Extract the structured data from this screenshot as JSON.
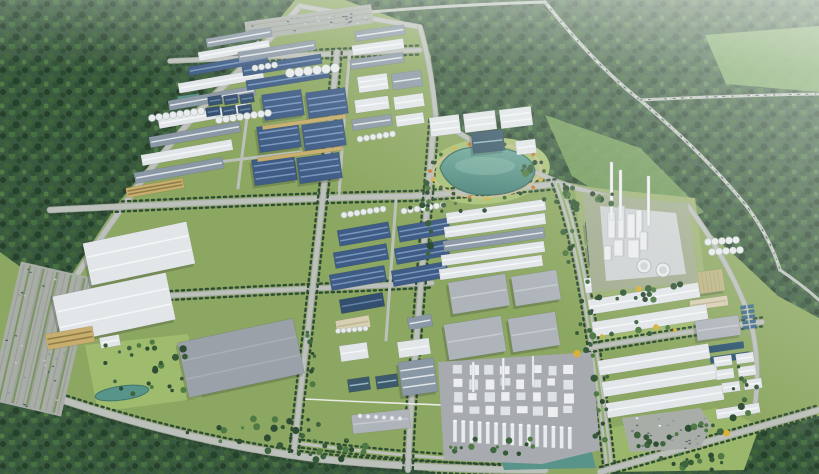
{
  "scene": {
    "width": 819,
    "height": 474,
    "description": "aerial-3d-render-industrial-park"
  },
  "palette": {
    "grassBase": "#8CA761",
    "grassLight": "#9FBB6E",
    "grassPark": "#A8C175",
    "forestMid": "#3A5A40",
    "clearing1": "#76A05C",
    "clearing2": "#7FAA64",
    "road": "#BCC0BA",
    "roadEdge": "#A4A8A2",
    "treeDark": "#2E4C33",
    "treeMid": "#3F653E",
    "treeAlt": "#365A38",
    "treeLight": "#4F7A43",
    "treeYellow": "#D9B13B",
    "shrubOrange": "#C97A35",
    "blue": "#3E5C85",
    "blueStripe": "#7E9CC2",
    "blued": "#344F6E",
    "bluedStripe": "#6888AC",
    "slate": "#8A97A5",
    "slateStripe": "#E8ECEF",
    "white": "#E2E6E9",
    "whiteStripe": "#F6F8F9",
    "gray": "#AEB4BA",
    "grayStripe": "#C8CDD1",
    "graybig": "#9BA1A8",
    "graybigStripe": "#AAB0B6",
    "beige": "#C7AE6E",
    "beigeStripe": "#8A7742",
    "beige2": "#D8CFB2",
    "beige2Stripe": "#BBB190",
    "tan": "#BDB583",
    "tanStripe": "#A8A171",
    "glass": "#3C5A6C",
    "glassStripe": "#9FC0C9",
    "lakeTop": "#6FA89A",
    "lakeBottom": "#4A8379",
    "lakeRim": "#3E6E66",
    "pond": "#58948A",
    "basin": "#2E5470",
    "basinLight": "#3A6A8C",
    "pad": "#A7ABAF",
    "padLight": "#CFD3D4",
    "siteGreen": "#A2AD90",
    "towerWhite": "#ECEEEF",
    "towerShade": "#BDC3C8",
    "parking": "#A9ADA8",
    "parkStripe": "#98A094",
    "pathBeige": "#C9BD96",
    "pipe": "#EDEDEA",
    "shadow": "rgba(35,45,40,0.22)",
    "carDark": "#4B545C",
    "carLight": "#E8ECEC"
  },
  "forests": [
    {
      "pts": "0,0 295,0 252,52 196,108 118,203 60,292 22,268 0,252"
    },
    {
      "pts": "345,0 819,0 819,318 778,296 742,262 704,228 690,207 642,199 602,189 560,181 436,119 431,56 419,27"
    },
    {
      "pts": "0,400 33,392 150,428 300,458 420,468 436,474 0,474"
    },
    {
      "pts": "608,474 819,416 819,474"
    }
  ],
  "clearings": [
    {
      "pts": "545,115 640,148 704,212 662,232 572,176",
      "c": "clearing1"
    },
    {
      "pts": "705,35 819,26 819,92 726,84",
      "c": "clearing2"
    }
  ],
  "lawns": [
    {
      "pts": "85,345 188,334 202,398 98,412",
      "c": "#9FBB6E"
    },
    {
      "pts": "588,332 712,318 716,332 592,348",
      "c": "#9FBB6E"
    },
    {
      "pts": "575,186 695,198 706,288 585,298",
      "c": "#9DB174"
    },
    {
      "pts": "600,430 716,408 760,425 744,470 612,472",
      "c": "#9BB76B"
    }
  ],
  "lakePark": {
    "cx": 487,
    "cy": 171,
    "rx": 63,
    "ry": 33,
    "rot": -5,
    "c": "#A8C175"
  },
  "roads": [
    {
      "d": "M300,6 C272,38 232,78 200,110 C152,163 100,235 63,298 C50,330 41,358 33,390",
      "w": 5
    },
    {
      "d": "M33,390 C120,420 220,447 320,459 C390,466 470,470 545,470",
      "w": 6,
      "t": "h"
    },
    {
      "d": "M290,442 C360,452 430,458 500,461",
      "w": 3,
      "t": "h"
    },
    {
      "d": "M300,6 C340,13 380,20 420,27",
      "w": 4
    },
    {
      "d": "M420,27 C429,58 433,88 436,118",
      "w": 4
    },
    {
      "d": "M436,118 C480,148 520,166 558,182 C600,198 644,203 688,206",
      "w": 4
    },
    {
      "d": "M50,210 C170,204 300,198 412,196 C462,193 516,188 558,184",
      "w": 5,
      "t": "h"
    },
    {
      "d": "M170,61 C255,57 340,53 420,50",
      "w": 4,
      "t": "h"
    },
    {
      "d": "M62,302 C160,296 260,290 352,287 C392,285 415,284 432,283",
      "w": 4,
      "t": "h"
    },
    {
      "d": "M558,184 C570,215 580,260 588,310 C596,360 604,420 610,474",
      "w": 7,
      "t": "v",
      "median": true
    },
    {
      "d": "M337,52 C330,140 318,240 308,330 C303,370 298,412 294,452",
      "w": 4.5,
      "t": "v"
    },
    {
      "d": "M434,120 C428,200 420,290 414,370 C411,405 409,440 408,470",
      "w": 4.5,
      "t": "v"
    },
    {
      "d": "M258,42 C250,90 244,140 238,188",
      "w": 3
    },
    {
      "d": "M350,52 C345,100 342,150 339,196",
      "w": 3
    },
    {
      "d": "M396,200 C392,250 389,300 386,340",
      "w": 3
    },
    {
      "d": "M145,172 C200,164 250,158 302,152",
      "w": 3
    },
    {
      "d": "M588,348 C650,338 710,328 762,322",
      "w": 4,
      "t": "h"
    },
    {
      "d": "M688,206 C712,238 732,272 746,308 C757,338 760,375 754,412",
      "w": 4
    },
    {
      "d": "M600,472 L819,410",
      "w": 5,
      "t": "h"
    },
    {
      "d": "M545,2 C572,36 604,72 640,100 C678,132 716,168 748,208 C764,230 774,250 780,270",
      "w": 3.5,
      "cars": true
    },
    {
      "d": "M640,100 C700,97 760,95 819,94",
      "w": 3,
      "cars": true
    },
    {
      "d": "M780,270 C795,280 808,290 819,300",
      "w": 3
    },
    {
      "d": "M348,14 C412,8 478,4 545,2",
      "w": 3
    }
  ],
  "pipeline": {
    "d": "M305,399 C360,402 420,404 467,406",
    "w": 1.6
  },
  "buildings": [
    [
      206,
      33,
      66,
      9,
      -10,
      "slate",
      1
    ],
    [
      198,
      46,
      72,
      9,
      -10,
      "white",
      1
    ],
    [
      188,
      60,
      80,
      9,
      -10,
      "blue",
      1
    ],
    [
      178,
      76,
      86,
      10,
      -10,
      "white",
      1
    ],
    [
      168,
      93,
      88,
      10,
      -10,
      "slate",
      1
    ],
    [
      158,
      111,
      90,
      10,
      -10,
      "white",
      1
    ],
    [
      149,
      129,
      92,
      11,
      -10,
      "slate",
      1
    ],
    [
      141,
      147,
      92,
      11,
      -10,
      "white",
      1
    ],
    [
      134,
      165,
      90,
      11,
      -10,
      "slate",
      1
    ],
    [
      126,
      183,
      58,
      10,
      -10,
      "beige",
      2
    ],
    [
      238,
      46,
      78,
      10,
      -9,
      "slate",
      1
    ],
    [
      242,
      60,
      80,
      10,
      -9,
      "blue",
      1
    ],
    [
      246,
      74,
      84,
      10,
      -9,
      "blue",
      1
    ],
    [
      263,
      92,
      40,
      26,
      -8,
      "blue",
      3
    ],
    [
      307,
      90,
      40,
      26,
      -8,
      "blue",
      3
    ],
    [
      258,
      124,
      42,
      26,
      -8,
      "blue",
      3
    ],
    [
      303,
      122,
      42,
      26,
      -8,
      "blue",
      3
    ],
    [
      253,
      157,
      43,
      26,
      -8,
      "blue",
      3
    ],
    [
      298,
      155,
      43,
      26,
      -8,
      "blue",
      3
    ],
    [
      262,
      120,
      84,
      4,
      -8,
      "beige",
      0
    ],
    [
      257,
      152,
      86,
      4,
      -8,
      "beige",
      0
    ],
    [
      208,
      96,
      14,
      9,
      -9,
      "blued",
      1
    ],
    [
      224,
      95,
      14,
      9,
      -9,
      "blued",
      1
    ],
    [
      240,
      94,
      14,
      9,
      -9,
      "blued",
      1
    ],
    [
      206,
      107,
      14,
      9,
      -9,
      "blued",
      1
    ],
    [
      222,
      106,
      14,
      9,
      -9,
      "blued",
      1
    ],
    [
      238,
      105,
      14,
      9,
      -9,
      "blued",
      1
    ],
    [
      355,
      28,
      50,
      10,
      -8,
      "slate",
      1
    ],
    [
      352,
      42,
      52,
      10,
      -8,
      "white",
      1
    ],
    [
      350,
      56,
      54,
      10,
      -8,
      "slate",
      1
    ],
    [
      358,
      75,
      30,
      16,
      -8,
      "white",
      2
    ],
    [
      392,
      72,
      30,
      16,
      -8,
      "slate",
      1
    ],
    [
      355,
      98,
      34,
      13,
      -8,
      "white",
      1
    ],
    [
      394,
      95,
      30,
      13,
      -8,
      "white",
      1
    ],
    [
      352,
      117,
      40,
      11,
      -8,
      "slate",
      1
    ],
    [
      396,
      114,
      28,
      11,
      -8,
      "white",
      1
    ],
    [
      430,
      116,
      30,
      19,
      -7,
      "white",
      2
    ],
    [
      464,
      112,
      32,
      19,
      -7,
      "white",
      2
    ],
    [
      500,
      108,
      32,
      19,
      -7,
      "white",
      2
    ],
    [
      472,
      131,
      32,
      21,
      -6,
      "glass",
      1
    ],
    [
      516,
      140,
      20,
      14,
      -7,
      "white",
      1
    ],
    [
      86,
      232,
      106,
      43,
      -12,
      "white",
      2
    ],
    [
      56,
      284,
      116,
      48,
      -12,
      "white",
      2
    ],
    [
      46,
      330,
      48,
      16,
      -10,
      "beige",
      2
    ],
    [
      100,
      336,
      20,
      11,
      -10,
      "white",
      1
    ],
    [
      338,
      226,
      52,
      16,
      -10,
      "blue",
      2
    ],
    [
      334,
      248,
      54,
      16,
      -10,
      "blue",
      2
    ],
    [
      330,
      270,
      56,
      16,
      -10,
      "blue",
      2
    ],
    [
      398,
      222,
      52,
      16,
      -10,
      "blue",
      2
    ],
    [
      395,
      244,
      54,
      16,
      -10,
      "blue",
      2
    ],
    [
      392,
      266,
      56,
      16,
      -10,
      "blue",
      2
    ],
    [
      340,
      296,
      44,
      14,
      -10,
      "blued",
      1
    ],
    [
      336,
      318,
      34,
      12,
      -10,
      "beige2",
      1
    ],
    [
      408,
      316,
      24,
      12,
      -10,
      "slate",
      1
    ],
    [
      182,
      330,
      118,
      56,
      -12,
      "graybig",
      2
    ],
    [
      446,
      206,
      100,
      11,
      -8,
      "white",
      1
    ],
    [
      444,
      220,
      102,
      11,
      -8,
      "white",
      1
    ],
    [
      443,
      234,
      102,
      11,
      -8,
      "slate",
      1
    ],
    [
      441,
      248,
      104,
      11,
      -8,
      "white",
      1
    ],
    [
      439,
      262,
      104,
      11,
      -8,
      "white",
      1
    ],
    [
      450,
      278,
      58,
      32,
      -9,
      "gray",
      1
    ],
    [
      513,
      273,
      46,
      30,
      -9,
      "gray",
      1
    ],
    [
      446,
      320,
      58,
      36,
      -9,
      "gray",
      1
    ],
    [
      510,
      315,
      48,
      34,
      -9,
      "gray",
      1
    ],
    [
      340,
      344,
      28,
      16,
      -8,
      "white",
      1
    ],
    [
      398,
      340,
      32,
      16,
      -8,
      "white",
      1
    ],
    [
      400,
      360,
      36,
      34,
      -8,
      "slate",
      3
    ],
    [
      348,
      378,
      22,
      13,
      -8,
      "glass",
      1
    ],
    [
      376,
      375,
      22,
      13,
      -8,
      "glass",
      1
    ],
    [
      352,
      412,
      58,
      19,
      -6,
      "gray",
      1
    ],
    [
      648,
      216,
      26,
      13,
      -6,
      "beige2",
      1
    ],
    [
      650,
      236,
      30,
      15,
      -6,
      "white",
      1
    ],
    [
      586,
      222,
      9,
      20,
      -6,
      "glass",
      1
    ],
    [
      588,
      245,
      9,
      20,
      -6,
      "glass",
      1
    ],
    [
      676,
      272,
      48,
      22,
      -8,
      "tan",
      0
    ],
    [
      690,
      298,
      38,
      10,
      -8,
      "beige2",
      1
    ],
    [
      584,
      270,
      108,
      15,
      -9,
      "white",
      1
    ],
    [
      588,
      291,
      112,
      15,
      -9,
      "white",
      1
    ],
    [
      592,
      313,
      116,
      15,
      -9,
      "white",
      1
    ],
    [
      598,
      352,
      112,
      15,
      -9,
      "white",
      1
    ],
    [
      602,
      373,
      116,
      15,
      -9,
      "white",
      1
    ],
    [
      606,
      394,
      118,
      15,
      -9,
      "white",
      1
    ],
    [
      696,
      318,
      44,
      20,
      -8,
      "gray",
      1
    ],
    [
      714,
      356,
      18,
      10,
      -8,
      "white",
      1
    ],
    [
      736,
      353,
      18,
      10,
      -8,
      "white",
      1
    ],
    [
      716,
      369,
      18,
      10,
      -8,
      "white",
      1
    ],
    [
      738,
      366,
      18,
      10,
      -8,
      "white",
      1
    ],
    [
      722,
      382,
      18,
      10,
      -8,
      "white",
      1
    ],
    [
      744,
      379,
      18,
      10,
      -8,
      "white",
      1
    ],
    [
      716,
      406,
      44,
      10,
      -9,
      "white",
      1
    ]
  ],
  "waterRects": [
    [
      178,
      95,
      22,
      12,
      -8,
      "#58948A"
    ],
    [
      701,
      322,
      16,
      6,
      -8,
      "#2E5470"
    ],
    [
      701,
      331,
      16,
      6,
      -8,
      "#2E5470"
    ],
    [
      704,
      344,
      40,
      7,
      -8,
      "#2E5470"
    ],
    [
      710,
      354,
      40,
      7,
      -8,
      "#2E5470"
    ]
  ],
  "basinGrid": {
    "x": 740,
    "y": 306,
    "cols": 2,
    "rows": 5,
    "cw": 6,
    "ch": 3.5,
    "g": 1.6,
    "rot": -8,
    "c": "#3A6A8C"
  },
  "tanks": [
    [
      152,
      118,
      8,
      3.5,
      7,
      -1
    ],
    [
      219,
      120,
      8,
      3.5,
      7,
      -1
    ],
    [
      290,
      73,
      6,
      4.5,
      9,
      -1
    ],
    [
      255,
      68,
      4,
      3,
      6.5,
      -1
    ],
    [
      344,
      215,
      7,
      3,
      6.5,
      -1
    ],
    [
      404,
      211,
      7,
      3,
      6.5,
      -1
    ],
    [
      360,
      139,
      6,
      3,
      6.5,
      -1
    ],
    [
      338,
      331,
      6,
      2.5,
      5.5,
      -0.5
    ],
    [
      708,
      242,
      5,
      3.5,
      7,
      -0.5
    ],
    [
      712,
      252,
      5,
      3.5,
      7,
      -0.5
    ],
    [
      360,
      416,
      6,
      2.2,
      8,
      0.5
    ]
  ],
  "lake": {
    "d": "M440,168 C446,150 468,145 492,147 C516,149 533,157 535,171 C533,186 512,195 487,195 C462,195 446,185 440,168 Z",
    "ring": {
      "cx": 487,
      "cy": 171,
      "rx": 54,
      "ry": 26,
      "rot": -4
    }
  },
  "flowers": {
    "cx": 487,
    "cy": 171,
    "rx": 57,
    "ry": 28,
    "n": 20
  },
  "ponds": [
    {
      "cx": 122,
      "cy": 393,
      "rx": 27,
      "ry": 7,
      "rot": -8
    }
  ],
  "waterStrips": [
    {
      "pts": "500,456 592,452 596,468 504,470"
    }
  ],
  "chemPlant": {
    "pad": "438,362 592,352 600,450 542,464 444,460",
    "grid": {
      "x": 452,
      "y": 364,
      "cols": 8,
      "rows": 4,
      "cw": 9,
      "ch": 8.5,
      "gx": 6.8,
      "gy": 5.2,
      "seed": 21
    },
    "chimneys": {
      "x": 453,
      "y": 421,
      "n": 15,
      "sp": 8.2,
      "w": 4,
      "h": 21,
      "drop": 0.5
    },
    "stacks": [
      [
        472,
        362,
        2.5,
        30
      ],
      [
        502,
        358,
        2.5,
        32
      ],
      [
        532,
        356,
        2,
        30
      ]
    ]
  },
  "rightPlant": {
    "site": "583,192 688,204 698,282 592,292",
    "pad": "600,206 676,213 686,274 606,281",
    "towers": [
      [
        608,
        212,
        8,
        26
      ],
      [
        618,
        206,
        7,
        32
      ],
      [
        627,
        214,
        9,
        24
      ],
      [
        636,
        210,
        7,
        28
      ],
      [
        614,
        240,
        10,
        16
      ],
      [
        628,
        240,
        12,
        18
      ],
      [
        604,
        246,
        8,
        14
      ],
      [
        640,
        232,
        8,
        18
      ]
    ],
    "stacks": [
      [
        610,
        162,
        3,
        58
      ],
      [
        619,
        170,
        3,
        50
      ],
      [
        647,
        176,
        3,
        50
      ]
    ],
    "cooling": [
      [
        644,
        266,
        7
      ],
      [
        663,
        270,
        7
      ]
    ]
  },
  "parkings": [
    {
      "x": 245,
      "y": 13,
      "w": 128,
      "h": 19,
      "rot": -8,
      "seed": 31,
      "rows": "h"
    },
    {
      "x": 4,
      "y": 268,
      "w": 74,
      "h": 142,
      "rot": 13,
      "seed": 32,
      "rows": "v"
    }
  ],
  "parkingPoly": {
    "pts": "622,418 700,408 712,425 700,448 630,452",
    "seed": 33,
    "bbox": [
      630,
      416,
      74,
      32
    ]
  },
  "treeClusters": [
    [
      140,
      368,
      26,
      48,
      26,
      1,
      0
    ],
    [
      250,
      432,
      22,
      70,
      14,
      2,
      0
    ],
    [
      320,
      450,
      18,
      60,
      10,
      3,
      0
    ],
    [
      480,
      447,
      14,
      55,
      8,
      4,
      0
    ],
    [
      570,
      225,
      12,
      8,
      38,
      5,
      0
    ],
    [
      585,
      320,
      12,
      8,
      40,
      6,
      1
    ],
    [
      602,
      408,
      10,
      8,
      34,
      7,
      0
    ],
    [
      592,
      200,
      12,
      52,
      7,
      8,
      0
    ],
    [
      640,
      292,
      14,
      48,
      8,
      9,
      1
    ],
    [
      748,
      388,
      10,
      16,
      30,
      10,
      0
    ],
    [
      690,
      462,
      16,
      45,
      8,
      11,
      0
    ],
    [
      430,
      222,
      10,
      5,
      40,
      12,
      0
    ],
    [
      312,
      362,
      8,
      5,
      30,
      13,
      0
    ],
    [
      448,
      206,
      9,
      42,
      6,
      14,
      0
    ],
    [
      540,
      168,
      6,
      18,
      6,
      15,
      0
    ],
    [
      640,
      330,
      8,
      40,
      8,
      16,
      1
    ],
    [
      660,
      442,
      8,
      26,
      8,
      17,
      0
    ],
    [
      700,
      430,
      10,
      30,
      8,
      18,
      1
    ]
  ]
}
